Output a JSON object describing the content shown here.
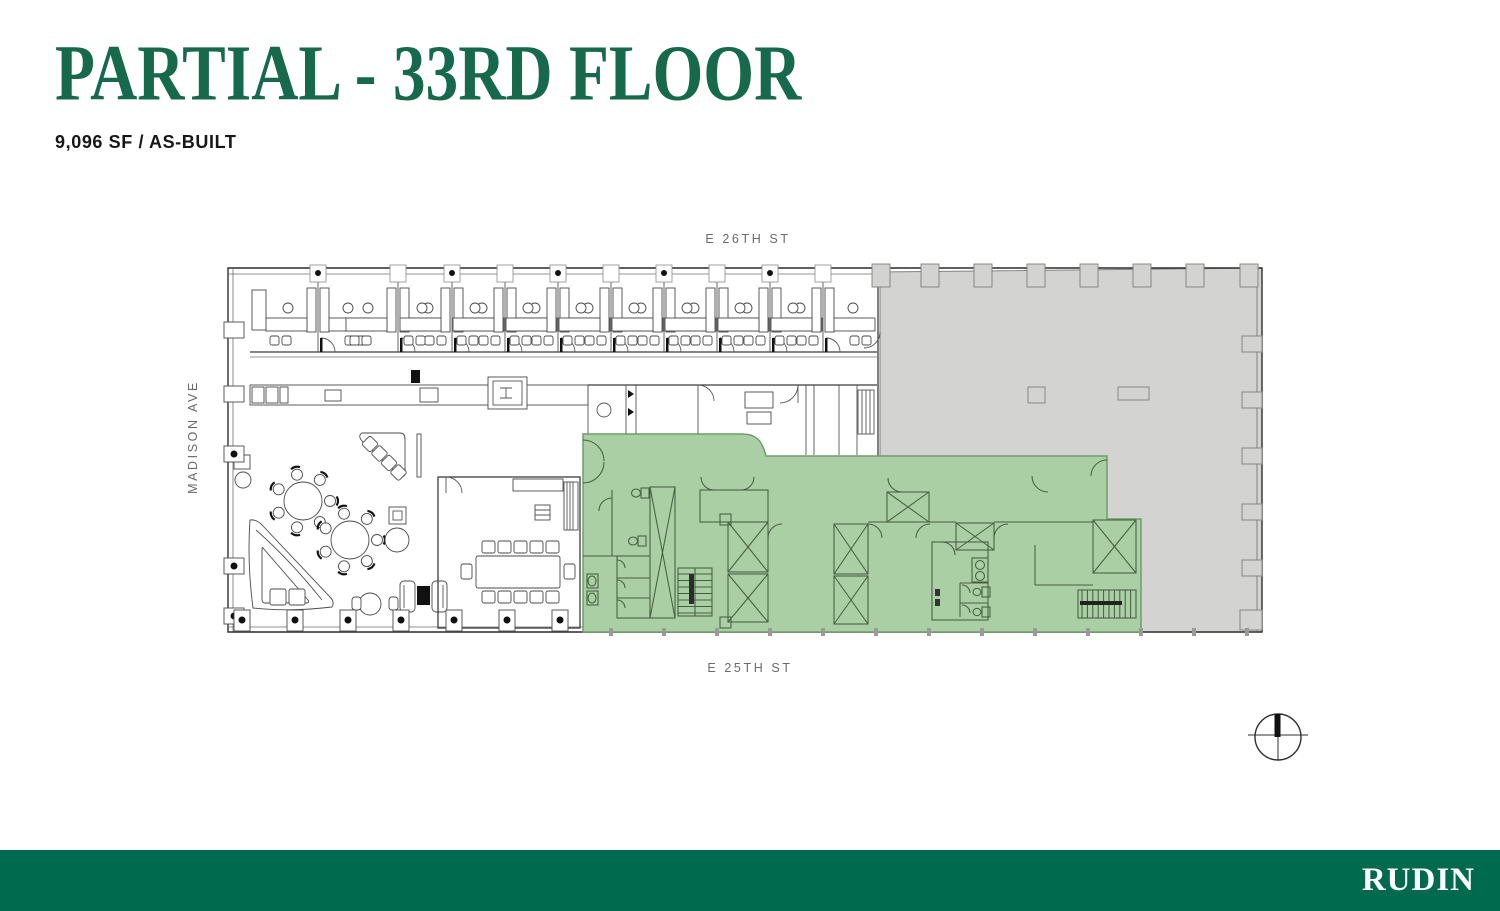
{
  "header": {
    "title": "PARTIAL - 33RD FLOOR",
    "subtitle": "9,096 SF / AS-BUILT",
    "title_color": "#17694b"
  },
  "plan": {
    "street_top": "E 26TH ST",
    "street_bottom": "E 25TH ST",
    "street_left": "MADISON AVE",
    "legend": {
      "available_fill": "#abcfa5",
      "unavailable_fill": "#d3d3d1"
    }
  },
  "footer": {
    "logo": "RUDIN",
    "background": "#006a4e"
  }
}
